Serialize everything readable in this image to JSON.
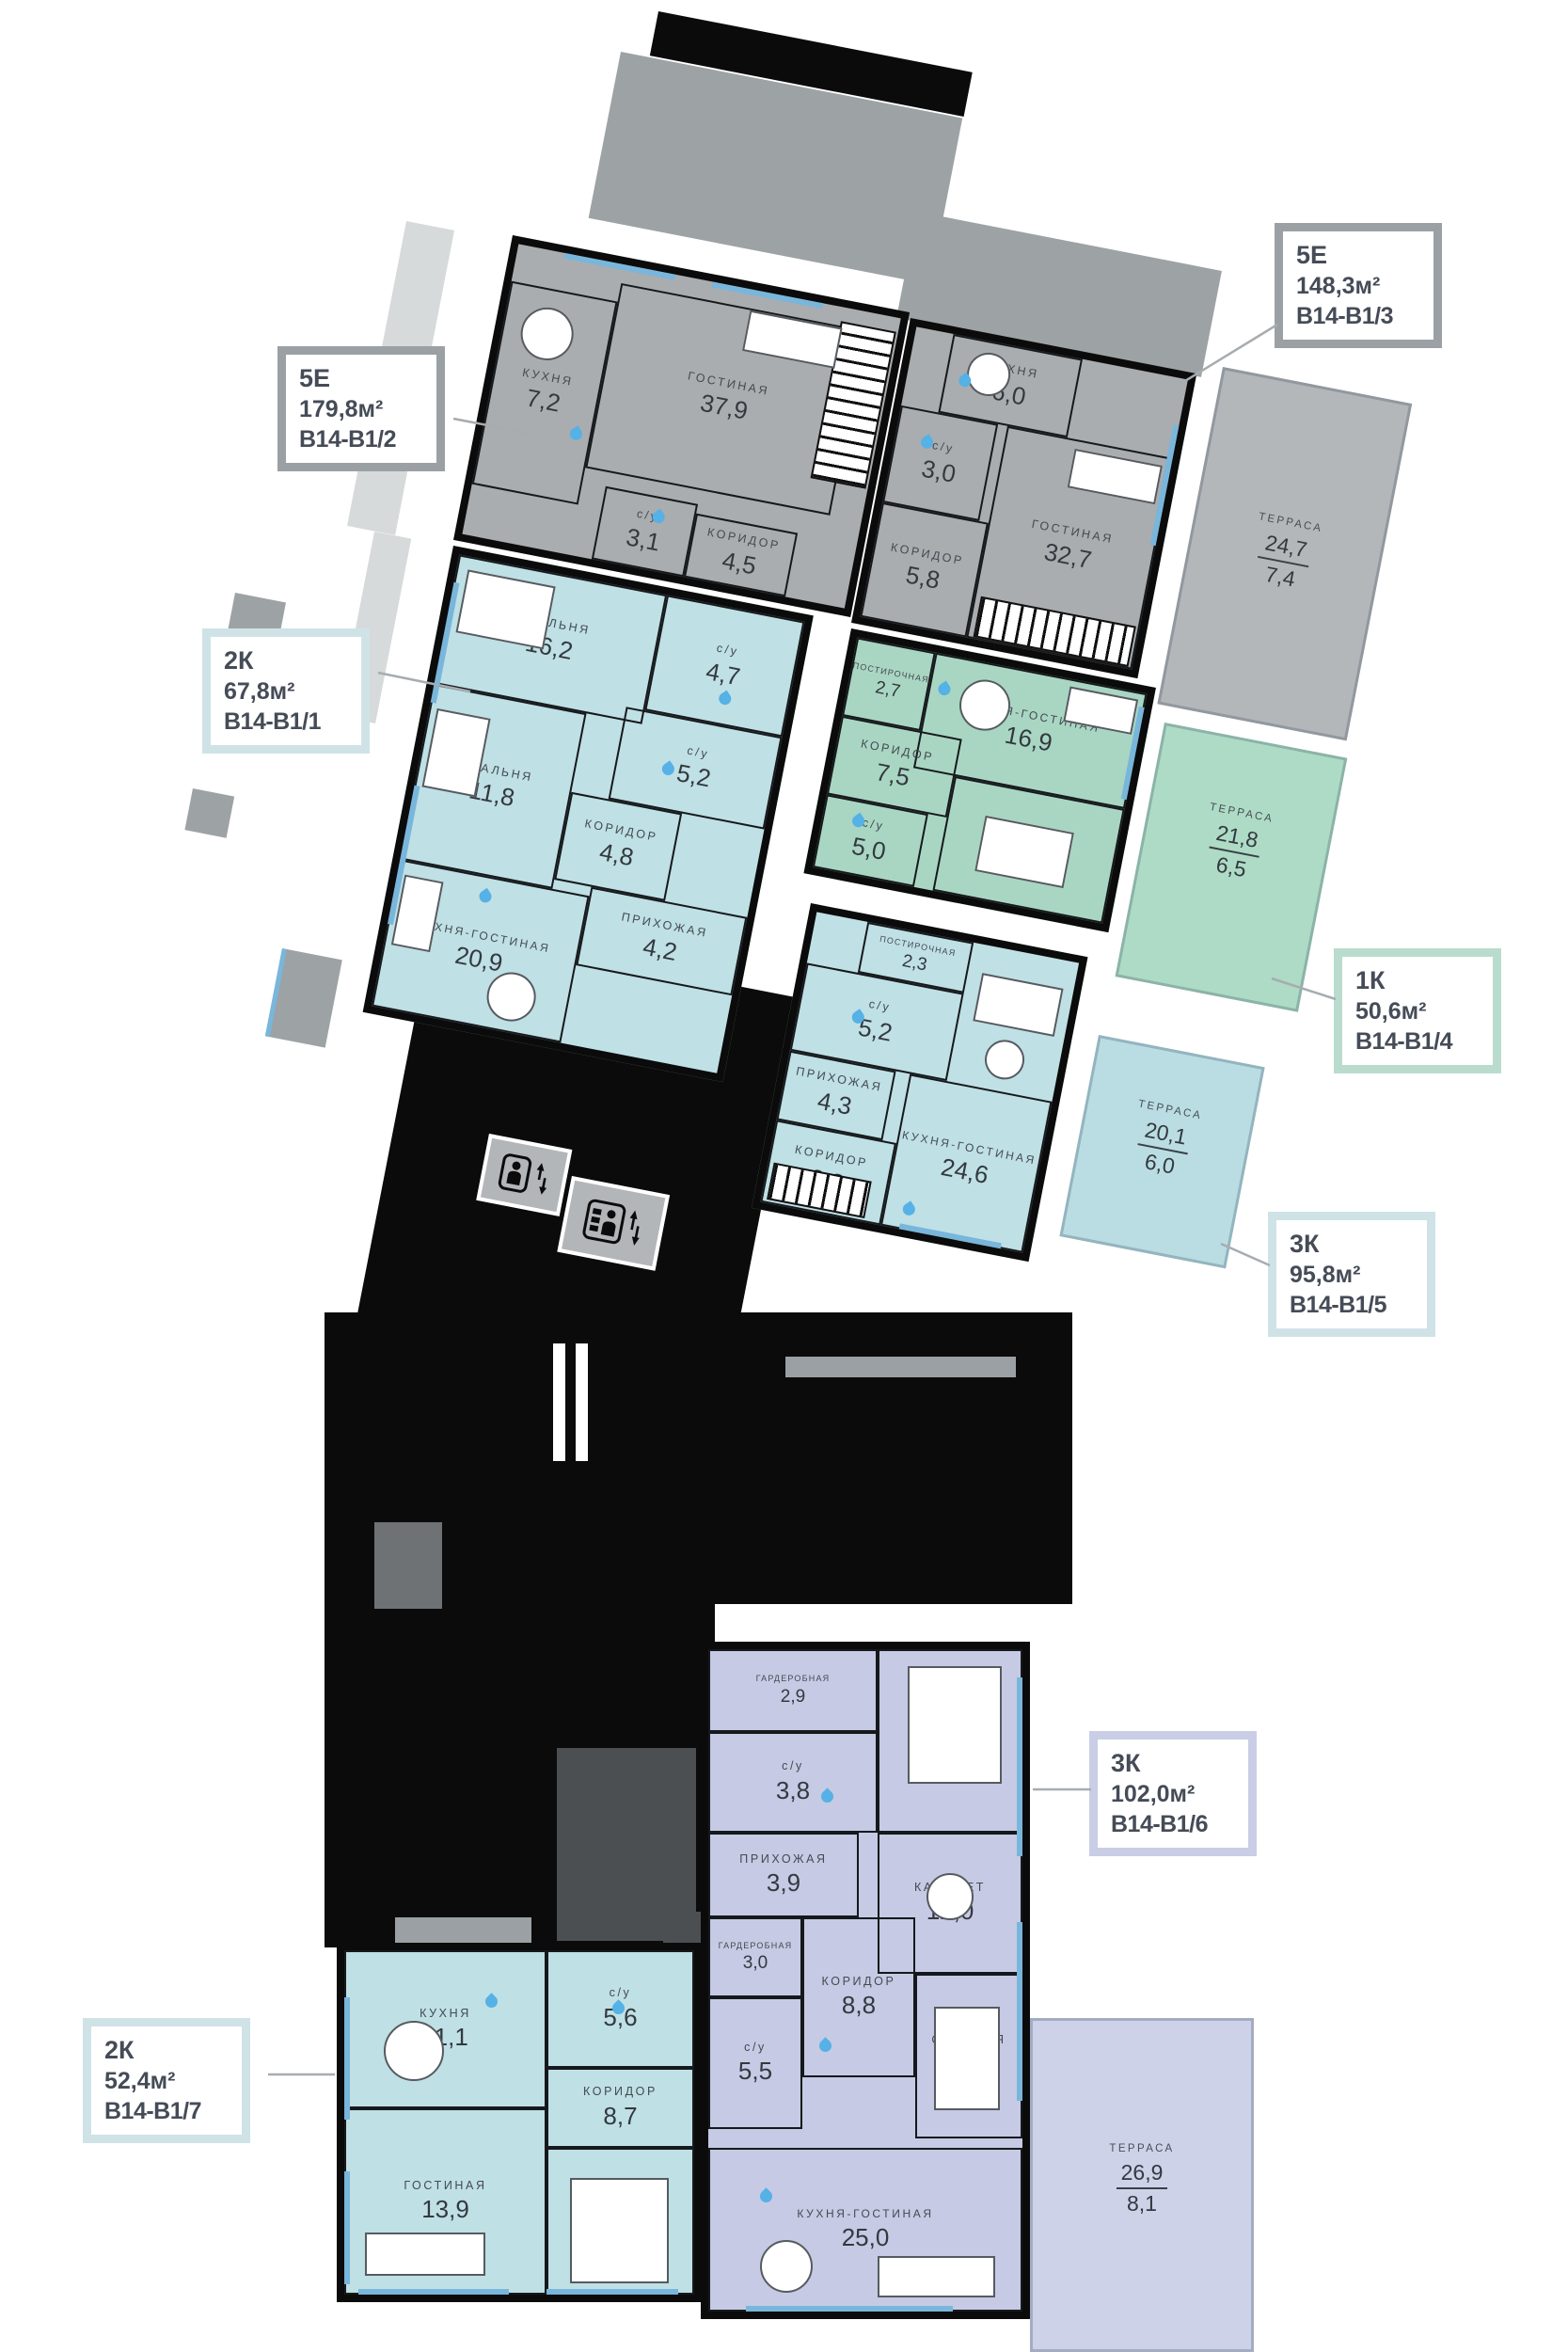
{
  "apartments": [
    {
      "code": "В14-В1/2",
      "color": "gray",
      "rooms": [
        {
          "name": "ГОСТИНАЯ",
          "area": "37,9"
        },
        {
          "name": "КУХНЯ",
          "area": "7,2"
        },
        {
          "name": "с/у",
          "area": "3,1"
        },
        {
          "name": "КОРИДОР",
          "area": "4,5"
        }
      ]
    },
    {
      "code": "В14-В1/3",
      "color": "gray",
      "rooms": [
        {
          "name": "КУХНЯ",
          "area": "6,0"
        },
        {
          "name": "с/у",
          "area": "3,0"
        },
        {
          "name": "КОРИДОР",
          "area": "5,8"
        },
        {
          "name": "ГОСТИНАЯ",
          "area": "32,7"
        }
      ]
    },
    {
      "code": "В14-В1/1",
      "color": "blue",
      "rooms": [
        {
          "name": "СПАЛЬНЯ",
          "area": "16,2"
        },
        {
          "name": "с/у",
          "area": "4,7"
        },
        {
          "name": "СПАЛЬНЯ",
          "area": "11,8"
        },
        {
          "name": "с/у",
          "area": "5,2"
        },
        {
          "name": "КОРИДОР",
          "area": "4,8"
        },
        {
          "name": "ПРИХОЖАЯ",
          "area": "4,2"
        },
        {
          "name": "КУХНЯ-ГОСТИНАЯ",
          "area": "20,9"
        }
      ]
    },
    {
      "code": "В14-В1/4",
      "color": "green",
      "rooms": [
        {
          "name": "ПОСТИРОЧНАЯ",
          "area": "2,7"
        },
        {
          "name": "КУХНЯ-ГОСТИНАЯ",
          "area": "16,9"
        },
        {
          "name": "КОРИДОР",
          "area": "7,5"
        },
        {
          "name": "СПАЛЬНЯ",
          "area": "12,0"
        },
        {
          "name": "с/у",
          "area": "5,0"
        }
      ]
    },
    {
      "code": "В14-В1/5",
      "color": "blue",
      "rooms": [
        {
          "name": "ПОСТИРОЧНАЯ",
          "area": "2,3"
        },
        {
          "name": "с/у",
          "area": "5,2"
        },
        {
          "name": "ПРИХОЖАЯ",
          "area": "4,3"
        },
        {
          "name": "КОРИДОР",
          "area": "8,3"
        },
        {
          "name": "КУХНЯ-ГОСТИНАЯ",
          "area": "24,6"
        }
      ]
    },
    {
      "code": "В14-В1/7",
      "color": "blue",
      "rooms": [
        {
          "name": "КУХНЯ",
          "area": "11,1"
        },
        {
          "name": "с/у",
          "area": "5,6"
        },
        {
          "name": "КОРИДОР",
          "area": "8,7"
        },
        {
          "name": "ГОСТИНАЯ",
          "area": "13,9"
        },
        {
          "name": "СПАЛЬНЯ",
          "area": "13,1"
        }
      ]
    },
    {
      "code": "В14-В1/6",
      "color": "purple",
      "rooms": [
        {
          "name": "ГАРДЕРОБНАЯ",
          "area": "2,9"
        },
        {
          "name": "с/у",
          "area": "3,8"
        },
        {
          "name": "СПАЛЬНЯ",
          "area": "17,1"
        },
        {
          "name": "ПРИХОЖАЯ",
          "area": "3,9"
        },
        {
          "name": "КАБИНЕТ",
          "area": "12,0"
        },
        {
          "name": "ГАРДЕРОБНАЯ",
          "area": "3,0"
        },
        {
          "name": "КОРИДОР",
          "area": "8,8"
        },
        {
          "name": "СПАЛЬНЯ",
          "area": "11,9"
        },
        {
          "name": "с/у",
          "area": "5,5"
        },
        {
          "name": "КУХНЯ-ГОСТИНАЯ",
          "area": "25,0"
        }
      ]
    }
  ],
  "terraces": [
    {
      "name": "ТЕРРАСА",
      "total": "24,7",
      "reduced": "7,4"
    },
    {
      "name": "ТЕРРАСА",
      "total": "21,8",
      "reduced": "6,5"
    },
    {
      "name": "ТЕРРАСА",
      "total": "20,1",
      "reduced": "6,0"
    },
    {
      "name": "ТЕРРАСА",
      "total": "26,9",
      "reduced": "8,1"
    }
  ],
  "callouts": [
    {
      "type": "5Е",
      "area": "148,3м²",
      "code": "В14-В1/3",
      "accent": "#9ba0a5"
    },
    {
      "type": "5Е",
      "area": "179,8м²",
      "code": "В14-В1/2",
      "accent": "#9ba0a5"
    },
    {
      "type": "2К",
      "area": "67,8м²",
      "code": "В14-В1/1",
      "accent": "#cfe3e7"
    },
    {
      "type": "1К",
      "area": "50,6м²",
      "code": "В14-В1/4",
      "accent": "#b9dccf"
    },
    {
      "type": "3К",
      "area": "95,8м²",
      "code": "В14-В1/5",
      "accent": "#cfe3e7"
    },
    {
      "type": "3К",
      "area": "102,0м²",
      "code": "В14-В1/6",
      "accent": "#c9cde6"
    },
    {
      "type": "2К",
      "area": "52,4м²",
      "code": "В14-В1/7",
      "accent": "#cfe3e7"
    }
  ],
  "icons": {
    "water_drop": "teardrop",
    "elevator_passenger": "person + up/down arrows",
    "elevator_cargo": "person + shelves + up/down arrows",
    "stairs": "striped steps"
  },
  "colors": {
    "wall": "#0b0b0b",
    "gray_unit": "#a9adb0",
    "blue_unit": "#bfe0e5",
    "green_unit": "#a9d6c3",
    "purple_unit": "#c6cae4",
    "window": "#79b6db",
    "drop": "#55b1e6",
    "label": "#434a51"
  }
}
